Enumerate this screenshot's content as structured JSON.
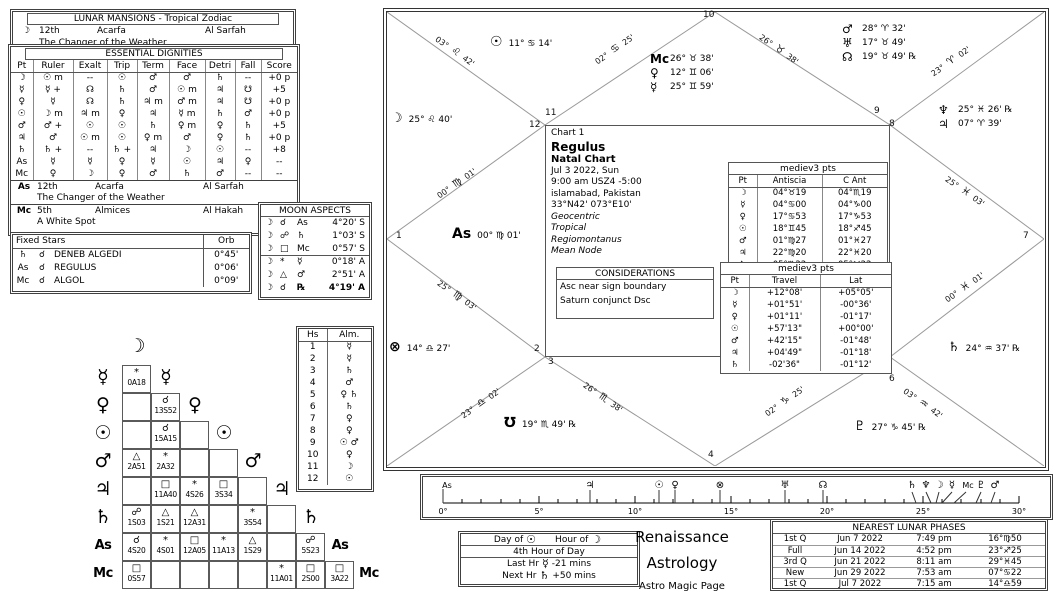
{
  "lunar_mansions": {
    "title": "LUNAR MANSIONS - Tropical Zodiac",
    "glyph": "☽",
    "ordinal": "12th",
    "name": "Acarfa",
    "arabic": "Al Sarfah",
    "meaning": "The Changer of the Weather"
  },
  "dignities": {
    "title": "ESSENTIAL DIGNITIES",
    "headers": [
      "Pt",
      "Ruler",
      "Exalt",
      "Trip",
      "Term",
      "Face",
      "Detri",
      "Fall",
      "Score"
    ],
    "rows": [
      [
        "☽",
        "☉ m",
        "--",
        "☉",
        "♂",
        "♂",
        "♄",
        "--",
        "+0 p"
      ],
      [
        "☿",
        "☿ +",
        "☊",
        "♄",
        "♂",
        "☉ m",
        "♃",
        "☋",
        "+5"
      ],
      [
        "♀",
        "☿",
        "☊",
        "♄",
        "♃ m",
        "♂ m",
        "♃",
        "☋",
        "+0 p"
      ],
      [
        "☉",
        "☽ m",
        "♃ m",
        "♀",
        "♃",
        "☿ m",
        "♄",
        "♂",
        "+0 p"
      ],
      [
        "♂",
        "♂ +",
        "☉",
        "☉",
        "♄",
        "♀ m",
        "♀",
        "♄",
        "+5"
      ],
      [
        "♃",
        "♂",
        "☉ m",
        "☉",
        "♀ m",
        "♂",
        "♀",
        "♄",
        "+0 p"
      ],
      [
        "♄",
        "♄ +",
        "--",
        "♄ +",
        "♃",
        "☽",
        "☉",
        "--",
        "+8"
      ],
      [
        "As",
        "☿",
        "☿",
        "♀",
        "☿",
        "☉",
        "♃",
        "♀",
        "--"
      ],
      [
        "Mc",
        "♀",
        "☽",
        "♀",
        "♂",
        "♄",
        "♂",
        "--",
        "--"
      ]
    ]
  },
  "mansions2": {
    "as": {
      "glyph": "As",
      "ordinal": "12th",
      "name": "Acarfa",
      "arabic": "Al Sarfah",
      "meaning": "The Changer of the Weather"
    },
    "mc": {
      "glyph": "Mc",
      "ordinal": "5th",
      "name": "Almices",
      "arabic": "Al Hakah",
      "meaning": "A White Spot"
    }
  },
  "fixed_stars": {
    "title": "Fixed Stars",
    "orb_header": "Orb",
    "rows": [
      [
        "♄",
        "☌",
        "DENEB ALGEDI",
        "0°45'"
      ],
      [
        "As",
        "☌",
        "REGULUS",
        "0°06'"
      ],
      [
        "Mc",
        "☌",
        "ALGOL",
        "0°09'"
      ]
    ]
  },
  "moon_aspects": {
    "title": "MOON ASPECTS",
    "rows": [
      [
        "☽",
        "☌",
        "As",
        "4°20' S"
      ],
      [
        "☽",
        "☍",
        "♄",
        "1°03' S"
      ],
      [
        "☽",
        "□",
        "Mc",
        "0°57' S"
      ],
      [
        "☽",
        "*",
        "☿",
        "0°18' A"
      ],
      [
        "☽",
        "△",
        "♂",
        "2°51' A"
      ],
      [
        "☽",
        "☌",
        "℞",
        "4°19' A"
      ]
    ]
  },
  "grid": {
    "top_glyph": "☽",
    "rows": [
      {
        "p": "☿",
        "cells": [
          {
            "a": "*",
            "v": "0A18"
          }
        ]
      },
      {
        "p": "♀",
        "cells": [
          null,
          {
            "a": "☌",
            "v": "13S52"
          }
        ]
      },
      {
        "p": "☉",
        "cells": [
          null,
          {
            "a": "☌",
            "v": "15A15"
          },
          null
        ]
      },
      {
        "p": "♂",
        "cells": [
          {
            "a": "△",
            "v": "2A51"
          },
          {
            "a": "*",
            "v": "2A32"
          },
          null,
          null
        ]
      },
      {
        "p": "♃",
        "cells": [
          null,
          {
            "a": "□",
            "v": "11A40"
          },
          {
            "a": "*",
            "v": "4S26"
          },
          {
            "a": "□",
            "v": "3S34"
          },
          null
        ]
      },
      {
        "p": "♄",
        "cells": [
          {
            "a": "☍",
            "v": "1S03"
          },
          {
            "a": "△",
            "v": "1S21"
          },
          {
            "a": "△",
            "v": "12A31"
          },
          null,
          {
            "a": "*",
            "v": "3S54"
          },
          null
        ]
      },
      {
        "p": "As",
        "cells": [
          {
            "a": "☌",
            "v": "4S20"
          },
          {
            "a": "*",
            "v": "4S01"
          },
          {
            "a": "□",
            "v": "12A05"
          },
          {
            "a": "*",
            "v": "11A13"
          },
          {
            "a": "△",
            "v": "1S29"
          },
          null,
          {
            "a": "☍",
            "v": "5S23"
          }
        ]
      },
      {
        "p": "Mc",
        "cells": [
          {
            "a": "□",
            "v": "0S57"
          },
          null,
          null,
          null,
          null,
          {
            "a": "*",
            "v": "11A01"
          },
          {
            "a": "□",
            "v": "2S00"
          },
          {
            "a": "□",
            "v": "3A22"
          }
        ]
      }
    ]
  },
  "almutens": {
    "headers": [
      "Hs",
      "Alm."
    ],
    "rows": [
      [
        "1",
        "☿"
      ],
      [
        "2",
        "☿"
      ],
      [
        "3",
        "♄"
      ],
      [
        "4",
        "♂"
      ],
      [
        "5",
        "♀ ♄"
      ],
      [
        "6",
        "♄"
      ],
      [
        "7",
        "♀"
      ],
      [
        "8",
        "♀"
      ],
      [
        "9",
        "☉ ♂"
      ],
      [
        "10",
        "♀"
      ],
      [
        "11",
        "☽"
      ],
      [
        "12",
        "☉"
      ]
    ]
  },
  "wheel": {
    "center": {
      "chart_label": "Chart 1",
      "name": "Regulus",
      "type": "Natal Chart",
      "date": "Jul 3 2022, Sun",
      "time": "9:00 am  USZ4 -5:00",
      "place": "islamabad, Pakistan",
      "coords": "33°N42' 073°E10'",
      "setting1": "Geocentric",
      "setting2": "Tropical",
      "setting3": "Regiomontanus",
      "setting4": "Mean Node"
    },
    "planets": {
      "sun": {
        "glyph": "☉",
        "text": "11° ♋ 14'"
      },
      "moon": {
        "glyph": "☽",
        "text": "25° ♌ 40'"
      },
      "mc": {
        "glyph": "Mc",
        "text": "26° ♉ 38'"
      },
      "venus": {
        "glyph": "♀",
        "text": "12° ♊ 06'"
      },
      "mercury": {
        "glyph": "☿",
        "text": "25° ♊ 59'"
      },
      "mars": {
        "glyph": "♂",
        "text": "28° ♈ 32'"
      },
      "uranus": {
        "glyph": "♅",
        "text": "17° ♉ 49'"
      },
      "north_node": {
        "glyph": "☊",
        "text": "19° ♉ 49' ℞"
      },
      "asc": {
        "glyph": "As",
        "text": "00° ♍ 01'"
      },
      "fortune": {
        "glyph": "⊗",
        "text": "14° ♎ 27'"
      },
      "south_node": {
        "glyph": "℧",
        "text": "19° ♏ 49' ℞"
      },
      "pluto": {
        "glyph": "♇",
        "text": "27° ♑ 45' ℞"
      },
      "saturn": {
        "glyph": "♄",
        "text": "24° ♒ 37' ℞"
      },
      "neptune": {
        "glyph": "♆",
        "text": "25° ♓ 26' ℞"
      },
      "jupiter": {
        "glyph": "♃",
        "text": "07° ♈ 39'"
      }
    },
    "cusps": [
      {
        "d": "00°",
        "s": "♍",
        "m": "01'"
      },
      {
        "d": "25°",
        "s": "♍",
        "m": "03'"
      },
      {
        "d": "23°",
        "s": "♎",
        "m": "02'"
      },
      {
        "d": "26°",
        "s": "♏",
        "m": "38'"
      },
      {
        "d": "02°",
        "s": "♑",
        "m": "25'"
      },
      {
        "d": "03°",
        "s": "♒",
        "m": "42'"
      },
      {
        "d": "00°",
        "s": "♓",
        "m": "01'"
      },
      {
        "d": "25°",
        "s": "♓",
        "m": "03'"
      },
      {
        "d": "23°",
        "s": "♈",
        "m": "02'"
      },
      {
        "d": "26°",
        "s": "♉",
        "m": "38'"
      },
      {
        "d": "02°",
        "s": "♋",
        "m": "25'"
      },
      {
        "d": "03°",
        "s": "♌",
        "m": "42'"
      }
    ],
    "house_numbers": [
      "1",
      "2",
      "3",
      "4",
      "5",
      "6",
      "7",
      "8",
      "9",
      "10",
      "11",
      "12"
    ],
    "antiscia": {
      "title": "mediev3 pts",
      "headers": [
        "Pt",
        "Antiscia",
        "C Ant"
      ],
      "rows": [
        [
          "☽",
          "04°♉19",
          "04°♏19"
        ],
        [
          "☿",
          "04°♋00",
          "04°♑00"
        ],
        [
          "♀",
          "17°♋53",
          "17°♑53"
        ],
        [
          "☉",
          "18°♊45",
          "18°♐45"
        ],
        [
          "♂",
          "01°♍27",
          "01°♓27"
        ],
        [
          "♃",
          "22°♍20",
          "22°♓20"
        ],
        [
          "♄",
          "05°♏22",
          "05°♉22"
        ]
      ]
    },
    "travel": {
      "title": "mediev3 pts",
      "headers": [
        "Pt",
        "Travel",
        "Lat"
      ],
      "rows": [
        [
          "☽",
          "+12°08'",
          "+05°05'"
        ],
        [
          "☿",
          "+01°51'",
          "-00°36'"
        ],
        [
          "♀",
          "+01°11'",
          "-01°17'"
        ],
        [
          "☉",
          "+57'13\"",
          "+00°00'"
        ],
        [
          "♂",
          "+42'15\"",
          "-01°48'"
        ],
        [
          "♃",
          "+04'49\"",
          "-01°18'"
        ],
        [
          "♄",
          "-02'36\"",
          "-01°12'"
        ]
      ]
    },
    "considerations": {
      "title": "CONSIDERATIONS",
      "item1": "Asc near sign boundary",
      "item2": "Saturn conjunct Dsc"
    }
  },
  "ruler": {
    "tick_labels": [
      "0°",
      "5°",
      "10°",
      "15°",
      "20°",
      "25°",
      "30°"
    ],
    "markers": [
      "As",
      "♃",
      "☉",
      "♀",
      "⊗",
      "♅",
      "☊",
      "♄",
      "♆",
      "☽",
      "☿",
      "Mc",
      "♇",
      "♂"
    ]
  },
  "hours": {
    "day_label": "Day of",
    "day_glyph": "☉",
    "hour_label": "Hour of",
    "hour_glyph": "☽",
    "current": "4th Hour of Day",
    "last_label": "Last Hr",
    "last_glyph": "☿",
    "last_value": "-21 mins",
    "next_label": "Next Hr",
    "next_glyph": "♄",
    "next_value": "+50 mins"
  },
  "brand": {
    "line1": "Renaissance",
    "line2": "Astrology",
    "line3": "Astro Magic Page"
  },
  "phases": {
    "title": "NEAREST LUNAR PHASES",
    "rows": [
      [
        "1st Q",
        "Jun 7 2022",
        "7:49 pm",
        "16°♍50"
      ],
      [
        "Full",
        "Jun 14 2022",
        "4:52 pm",
        "23°♐25"
      ],
      [
        "3rd Q",
        "Jun 21 2022",
        "8:11 am",
        "29°♓45"
      ],
      [
        "New",
        "Jun 29 2022",
        "7:53 am",
        "07°♋22"
      ],
      [
        "1st Q",
        "Jul 7 2022",
        "7:15 am",
        "14°♎59"
      ]
    ]
  }
}
